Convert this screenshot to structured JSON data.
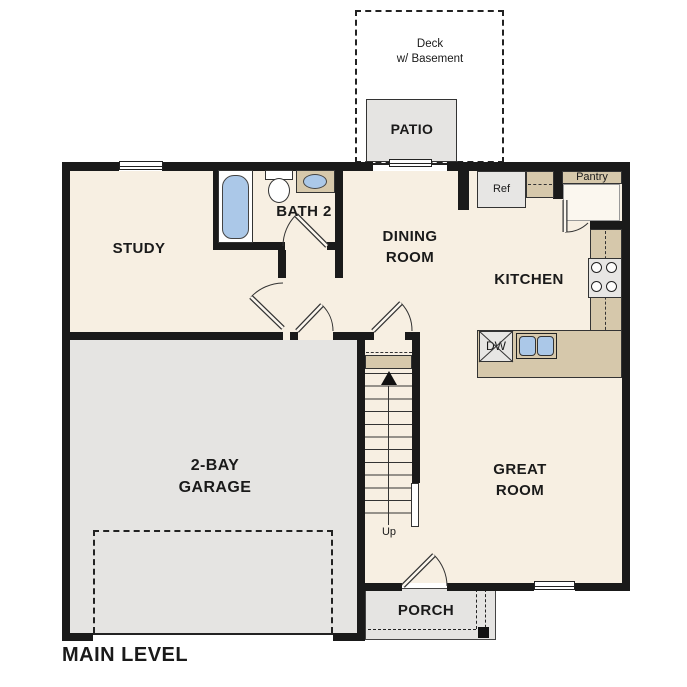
{
  "title": "MAIN LEVEL",
  "colors": {
    "floor": "#f7efe2",
    "garage": "#e5e4e2",
    "counter": "#d6c8ab",
    "fixture": "#abc8e8",
    "wall": "#1a1a1a",
    "appliance": "#e7e6e4"
  },
  "rooms": {
    "study": "STUDY",
    "bath": "BATH 2",
    "dining1": "DINING",
    "dining2": "ROOM",
    "kitchen": "KITCHEN",
    "great1": "GREAT",
    "great2": "ROOM",
    "garage1": "2-BAY",
    "garage2": "GARAGE",
    "porch": "PORCH",
    "patio": "PATIO",
    "deck1": "Deck",
    "deck2": "w/ Basement",
    "pantry": "Pantry"
  },
  "fixtures": {
    "ref": "Ref",
    "dw": "DW",
    "up": "Up"
  }
}
